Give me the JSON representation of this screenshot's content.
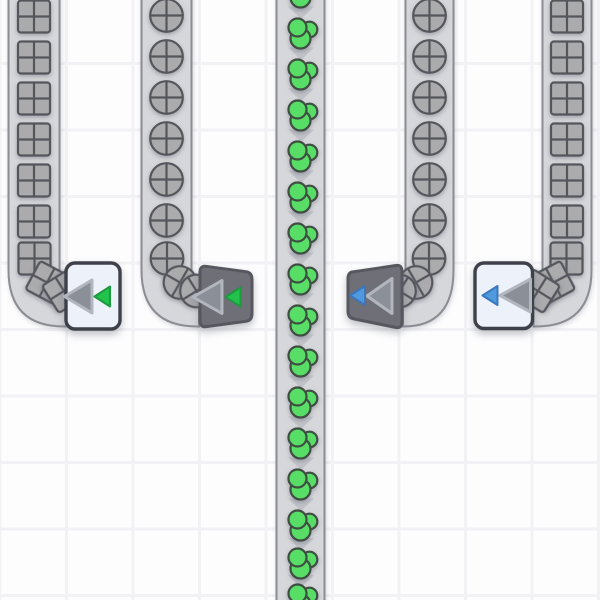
{
  "palette": {
    "background": "#fdfdfe",
    "grid_line": "#f2f2f5",
    "belt_fill": "#d6d7da",
    "belt_edge": "#8c8d94",
    "chevron": "#c2c3c9",
    "item_gray": "#ababad",
    "item_line": "#55565c",
    "green_item": "#58de66",
    "green_item_line": "#3f4d42",
    "light_body": "#edf1f9",
    "light_border": "#3f414a",
    "dark_body": "#6e6f77",
    "dark_border": "#56575f",
    "arrow_fill": "#8b8f98",
    "arrow_edge": "#b2b6be",
    "accent_green": "#22c24d",
    "accent_green_edge": "#1d9a40",
    "accent_blue": "#4f9ade",
    "accent_blue_edge": "#3a77bd"
  },
  "grid": {
    "cell": 66.5,
    "line_width": 3,
    "offset_x": -1.5,
    "offset_y": 62
  },
  "belts": [
    {
      "name": "belt-outer-left-squares",
      "item": "square",
      "left": 8.5,
      "width": 51,
      "turn": "right",
      "end_x": 66,
      "item_x": 34,
      "straight_item_ys": [
        16.5,
        57.5,
        98.5,
        139.5,
        180.5,
        221.5
      ],
      "turn_items": [
        {
          "x": 34.5,
          "y": 258.5,
          "rot": 0
        },
        {
          "x": 47,
          "y": 282.5,
          "rot": 28
        },
        {
          "x": 64,
          "y": 291,
          "rot": 58
        }
      ]
    },
    {
      "name": "belt-inner-left-circles",
      "item": "circle",
      "left": 141.5,
      "width": 50,
      "turn": "right",
      "end_x": 199,
      "item_x": 166.5,
      "straight_item_ys": [
        15.5,
        56.5,
        97.5,
        138.5,
        179.5,
        220.5
      ],
      "turn_items": [
        {
          "x": 167,
          "y": 258.5,
          "rot": 0
        },
        {
          "x": 180,
          "y": 282.5,
          "rot": 30
        },
        {
          "x": 196.5,
          "y": 291,
          "rot": 58
        }
      ]
    },
    {
      "name": "belt-center-green",
      "item": "green",
      "left": 276.5,
      "width": 48,
      "turn": "none",
      "item_x": 302,
      "straight_item_ys": [
        -8,
        33,
        74,
        115,
        156,
        197,
        238,
        279,
        320,
        361,
        402,
        443,
        484,
        525,
        563,
        599
      ],
      "chevron_ys": [
        12.5,
        53.5,
        94.5,
        135.5,
        176.5,
        217.5,
        258.5,
        299.5,
        340.5,
        381.5,
        422.5,
        463.5,
        504.5,
        544,
        581
      ],
      "turn_items": []
    },
    {
      "name": "belt-inner-right-circles",
      "item": "circle",
      "left": 405.5,
      "width": 48,
      "turn": "left",
      "end_x": 403,
      "item_x": 429.5,
      "straight_item_ys": [
        15.5,
        56.5,
        97.5,
        138.5,
        179.5,
        220.5
      ],
      "turn_items": [
        {
          "x": 429,
          "y": 258.5,
          "rot": 0
        },
        {
          "x": 416,
          "y": 282.5,
          "rot": -30
        },
        {
          "x": 399.5,
          "y": 291,
          "rot": -58
        }
      ]
    },
    {
      "name": "belt-outer-right-squares",
      "item": "square",
      "left": 542.5,
      "width": 49,
      "turn": "left",
      "end_x": 533.5,
      "item_x": 567,
      "straight_item_ys": [
        16.5,
        57.5,
        98.5,
        139.5,
        180.5,
        221.5
      ],
      "turn_items": [
        {
          "x": 566.5,
          "y": 258.5,
          "rot": 0
        },
        {
          "x": 553.5,
          "y": 282.5,
          "rot": -28
        },
        {
          "x": 538,
          "y": 291,
          "rot": -58
        }
      ]
    }
  ],
  "devices": [
    {
      "name": "belt-tunnel-light-green",
      "style": "light",
      "accent": "green",
      "rect": [
        66,
        263,
        54,
        66
      ],
      "big_arrow": [
        [
          64.5,
          296.5
        ],
        [
          92,
          280
        ],
        [
          92,
          313
        ]
      ],
      "small_arrow": [
        [
          94.5,
          296.5
        ],
        [
          110,
          286.5
        ],
        [
          110,
          306.5
        ]
      ]
    },
    {
      "name": "belt-tunnel-dark-green",
      "style": "dark",
      "accent": "green",
      "body_path": "M206,266.3 L246,271.7 Q252,272.5 252,279.5 L252,313.5 Q252,320.5 246,321.3 L206,326.7 Q200,327.5 200,320.5 L200,272.5 Q200,265.5 206,266.3 Z",
      "big_arrow": [
        [
          193,
          297
        ],
        [
          222,
          280.5
        ],
        [
          222,
          313.5
        ]
      ],
      "small_arrow": [
        [
          225.5,
          297
        ],
        [
          240.5,
          287.5
        ],
        [
          240.5,
          306.5
        ]
      ]
    },
    {
      "name": "belt-tunnel-dark-blue",
      "style": "dark",
      "accent": "blue",
      "body_path": "M354,271.7 L396,265.5 Q402,264.6 402,271.6 L402,321.4 Q402,328.4 396,327.5 L354,318.9 Q348,318 348,311 L348,278.7 Q348,271.7 354,271.7 Z",
      "big_arrow": [
        [
          367,
          296
        ],
        [
          392,
          278.5
        ],
        [
          392,
          313.5
        ]
      ],
      "small_arrow": [
        [
          350,
          295.5
        ],
        [
          365,
          286
        ],
        [
          365,
          305
        ]
      ]
    },
    {
      "name": "belt-tunnel-light-blue",
      "style": "light",
      "accent": "blue",
      "rect": [
        475,
        263,
        57.5,
        65.5
      ],
      "big_arrow": [
        [
          500,
          295.5
        ],
        [
          530.5,
          279
        ],
        [
          530.5,
          312
        ]
      ],
      "small_arrow": [
        [
          482.5,
          295.5
        ],
        [
          497.5,
          286
        ],
        [
          497.5,
          305
        ]
      ]
    }
  ]
}
